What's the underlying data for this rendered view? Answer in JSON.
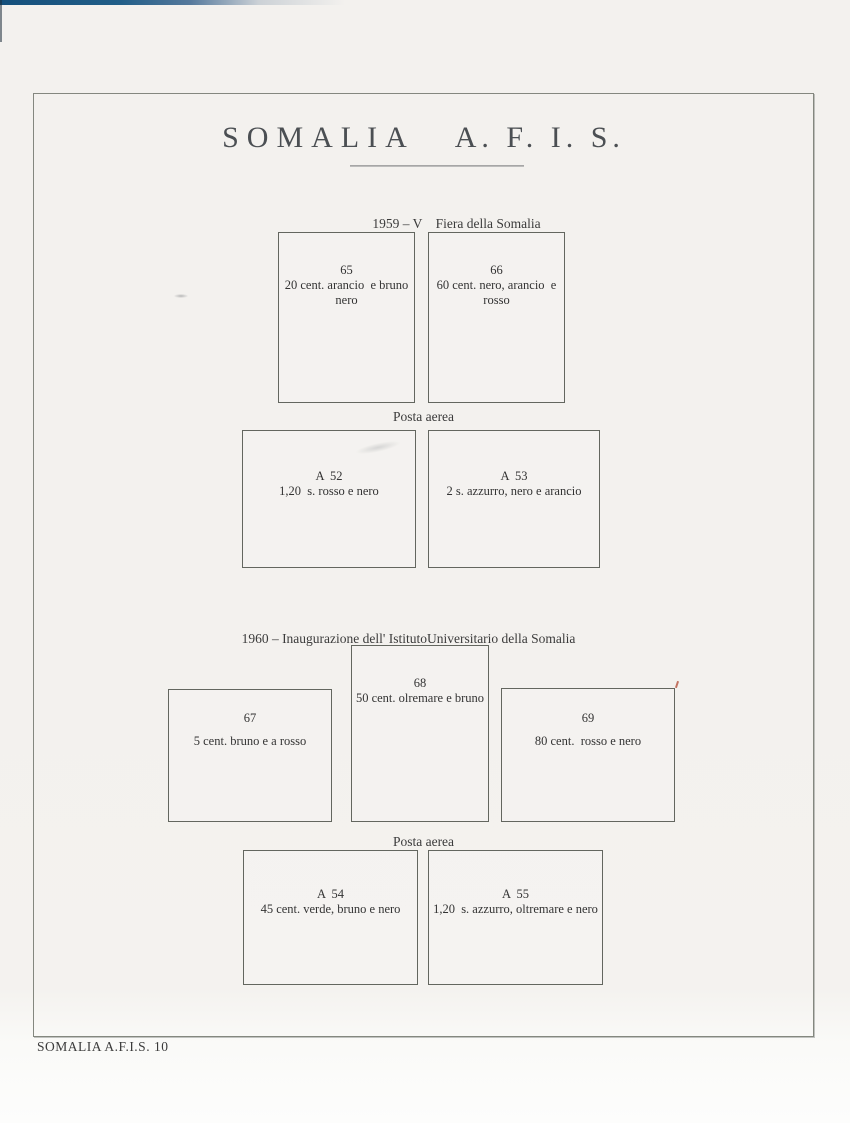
{
  "page": {
    "title_word1": "SOMALIA",
    "title_word2": "A. F. I. S.",
    "footer": "SOMALIA A.F.I.S. 10"
  },
  "headings": {
    "section_1959": "1959 – V    Fiera della Somalia",
    "posta_aerea_1": "Posta aerea",
    "section_1960": "1960 – Inaugurazione dell' IstitutoUniversitario della Somalia",
    "posta_aerea_2": "Posta aerea"
  },
  "stamps": {
    "s65": {
      "number": "65",
      "line1": "20 cent. arancio  e bruno",
      "line2": "nero"
    },
    "s66": {
      "number": "66",
      "line1": "60 cent. nero, arancio  e",
      "line2": "rosso"
    },
    "a52": {
      "number": "A  52",
      "line1": "1,20  s. rosso e nero"
    },
    "a53": {
      "number": "A  53",
      "line1": "2 s. azzurro, nero e arancio"
    },
    "s67": {
      "number": "67",
      "line1": "5 cent. bruno e a rosso"
    },
    "s68": {
      "number": "68",
      "line1": "50 cent. olremare e bruno"
    },
    "s69": {
      "number": "69",
      "line1": "80 cent.  rosso e nero"
    },
    "a54": {
      "number": "A  54",
      "line1": "45 cent. verde, bruno e nero"
    },
    "a55": {
      "number": "A  55",
      "line1": "1,20  s. azzurro, oltremare e nero"
    }
  },
  "colors": {
    "scan_strip_blue": "#15507c",
    "frame_border": "#84877f",
    "ink": "#3d3d3d",
    "red_tick": "#b5543e"
  }
}
